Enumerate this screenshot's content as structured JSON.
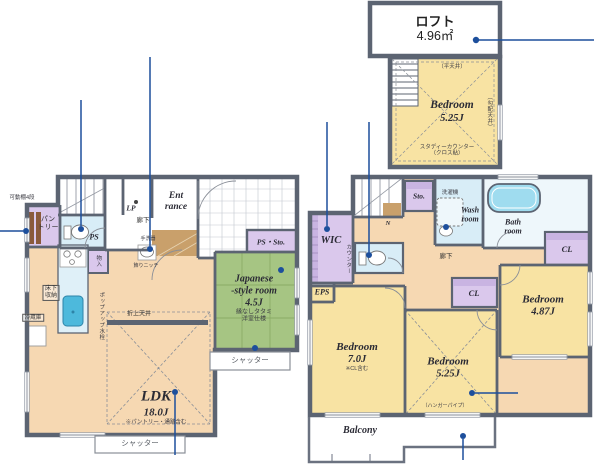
{
  "palette": {
    "wall": "#5c6472",
    "room_cream": "#f6d8b2",
    "room_yellow": "#f8e3a3",
    "tatami_green": "#a6c583",
    "closet_purple": "#dac8ec",
    "wet_blue": "#d8edf7",
    "tub_blue": "#9fdcef",
    "sink_blue": "#4db9dc",
    "wood_brown": "#c9a06b",
    "annotation_blue": "#1d4f9c"
  },
  "loft": {
    "name": "ロフト",
    "area": "4.96㎡",
    "bed": "Bedroom",
    "bed_size": "5.25J",
    "note_top": "（平天井）",
    "note_right": "（勾配天井）",
    "note_b1": "スタディーカウンター",
    "note_b2": "（クロス貼）"
  },
  "f1": {
    "pantry1": "パン",
    "pantry2": "トリー",
    "pantry_note": "可動棚4段",
    "ps": "PS",
    "lp": "LP",
    "hall": "廊下",
    "ent1": "Ent",
    "ent2": "rance",
    "ps_sto": "PS・Sto.",
    "tearai": "手洗器",
    "niche": "飾りニッチ",
    "mono": "物入",
    "popup": "ポップアップ水栓",
    "yuka1": "床下",
    "yuka2": "収納",
    "fridge": "冷蔵庫",
    "oriage": "折上天井",
    "ldk": "LDK",
    "ldk_size": "18.0J",
    "ldk_note": "※パントリー・通路含む",
    "jp1": "Japanese",
    "jp2": "-style room",
    "jp_size": "4.5J",
    "jp_note1": "縁なしタタミ",
    "jp_note2": "洋室仕様",
    "shutter": "シャッター"
  },
  "f2": {
    "wic": "WIC",
    "counter": "カウンター",
    "eps": "EPS",
    "sto": "Sto.",
    "washer": "洗濯機",
    "wash1": "Wash",
    "wash2": "room",
    "bath1": "Bath",
    "bath2": "room",
    "hall": "廊下",
    "north": "N",
    "cl": "CL",
    "bed7": "Bedroom",
    "bed7_size": "7.0J",
    "bed7_note": "※CL含む",
    "bed525": "Bedroom",
    "bed525_size": "5.25J",
    "bed525_note": "（ハンガーパイプ）",
    "bed487": "Bedroom",
    "bed487_size": "4.87J",
    "balcony": "Balcony"
  }
}
